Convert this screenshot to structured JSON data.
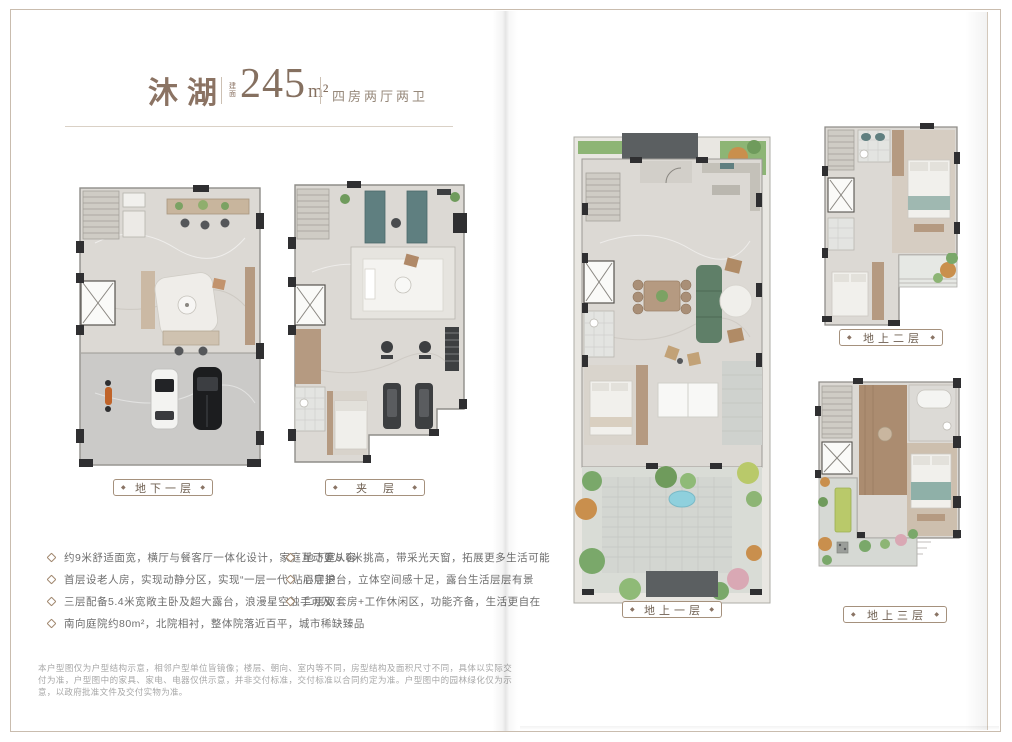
{
  "header": {
    "title": "沐湖",
    "area_label": "建面",
    "area_value": "245",
    "area_unit": "m²",
    "spec": "四房两厅两卫"
  },
  "plans": [
    {
      "label": "地下一层"
    },
    {
      "label": "夹层"
    },
    {
      "label": "地上一层"
    },
    {
      "label": "地上二层"
    },
    {
      "label": "地上三层"
    }
  ],
  "features_left": [
    "约9米舒适面宽，横厅与餐客厅一体化设计，家庭互动更从容",
    "首层设老人房，实现动静分区，实现“一层一代”贴心守护",
    "三层配备5.4米宽敞主卧及超大露台，浪漫星空触手可及",
    "南向庭院约80m²，北院相衬，整体院落近百平，城市稀缺臻品"
  ],
  "features_right": [
    "地下室5.6米挑高，带采光天窗，拓展更多生活可能",
    "层层退台，立体空间感十足，露台生活层层有景",
    "二层双套房+工作休闲区，功能齐备，生活更自在"
  ],
  "disclaimer": "本户型图仅为户型结构示意，相邻户型单位皆镜像；楼层、朝向、室内等不同，房型结构及面积尺寸不同，具体以实际交付为准，户型图中的家具、家电、电器仅供示意，并非交付标准，交付标准以合同约定为准。户型图中的园林绿化仅为示意，以政府批准文件及交付实物为准。",
  "icons": {
    "diamond": "◆",
    "bullet": "rotated-square-outline"
  },
  "colors": {
    "accent_brown": "#8b7363",
    "label_border": "#a5917d",
    "body_text": "#6e6e6e",
    "fine_print": "#a7a7a7",
    "frame_line": "#c9bcae",
    "floor_marble": "#dcd9d4",
    "garage_floor": "#cbcac8",
    "wood": "#b59a81",
    "sofa_green": "#5f7f68",
    "garden_green": "#8db575",
    "autumn_tree": "#c98f4d",
    "pool_blue": "#8fd0dd",
    "wall_dark": "#2f2f31",
    "canopy_gray": "#5b5f61"
  }
}
